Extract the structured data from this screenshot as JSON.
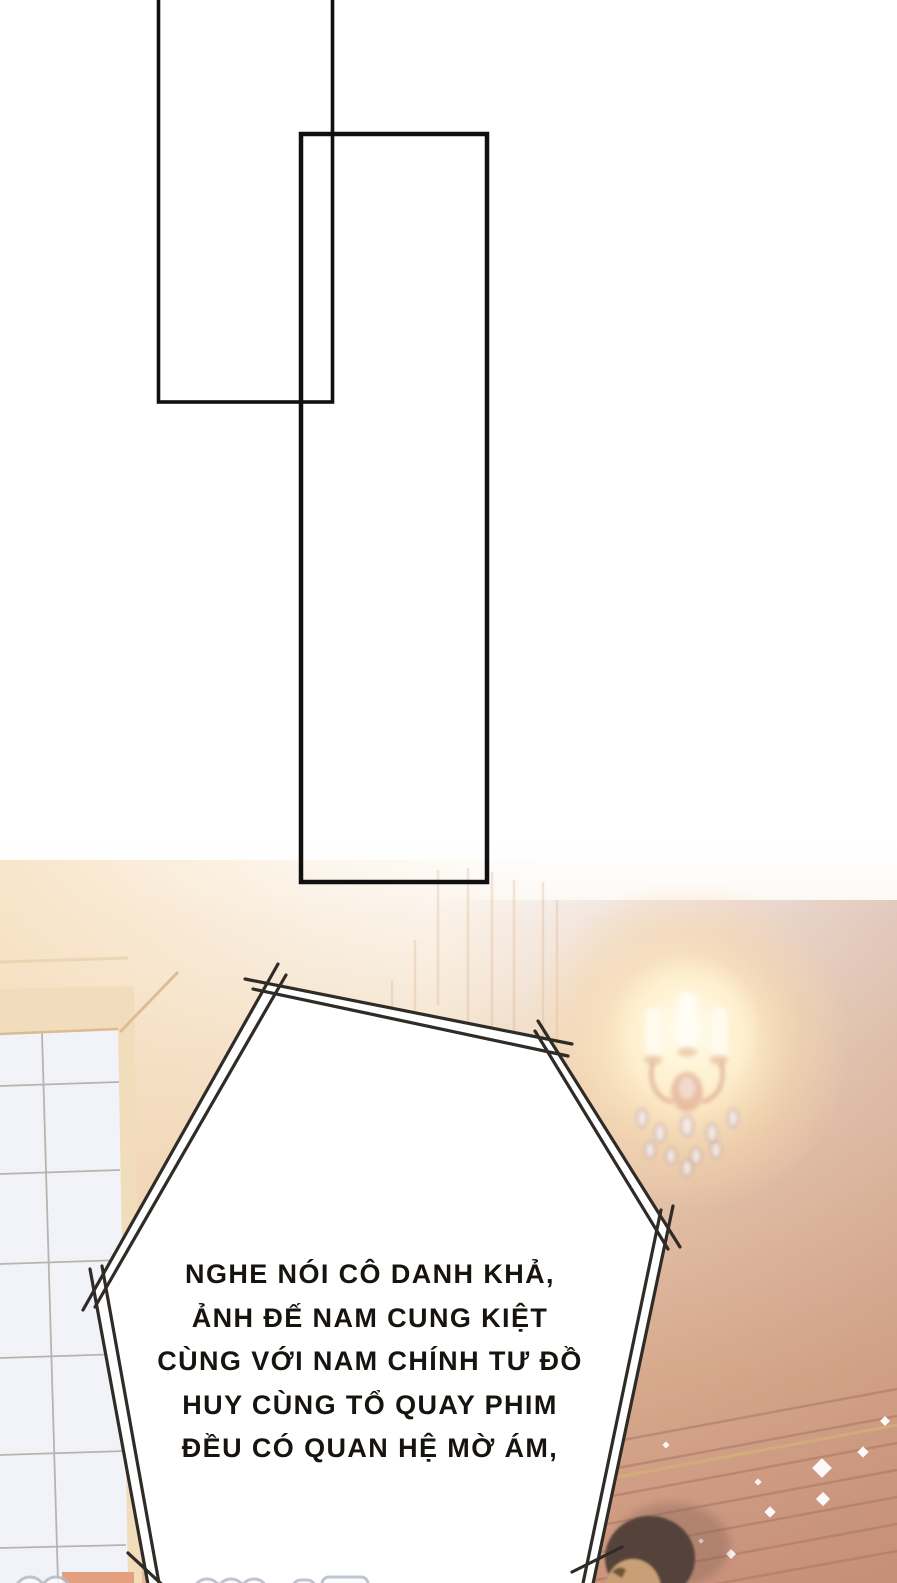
{
  "speech_bubble": {
    "lines": [
      "NGHE NÓI CÔ DANH KHẢ,",
      "ẢNH ĐẾ NAM CUNG KIỆT",
      "CÙNG VỚI NAM CHÍNH TƯ ĐỒ",
      "HUY CÙNG TỔ QUAY PHIM",
      "ĐỀU CÓ QUAN HỆ MỜ ÁM,"
    ],
    "full_text": "NGHE NÓI CÔ DANH KHẢ, ẢNH ĐẾ NAM CUNG KIỆT CÙNG VỚI NAM CHÍNH TƯ ĐỒ HUY CÙNG TỔ QUAY PHIM ĐỀU CÓ QUAN HỆ MỜ ÁM,"
  },
  "colors": {
    "bubble_fill": "#ffffff",
    "bubble_border": "#2f2b26",
    "panel_border": "#101010",
    "wall_cream": "#f7e4cc",
    "wall_rose": "#cf9b81",
    "wall_slat_line": "#a87863",
    "glow_warm": "#ffeec9",
    "window_tile": "#f2f3f9",
    "window_grid": "#aaa59b",
    "window_frame": "#f1ddbb",
    "sill": "#e2a07e",
    "hair": "#55433b",
    "skin": "#c89f77",
    "sparkle": "#ffffff",
    "cutoff_blob_line": "#b5bac8"
  }
}
